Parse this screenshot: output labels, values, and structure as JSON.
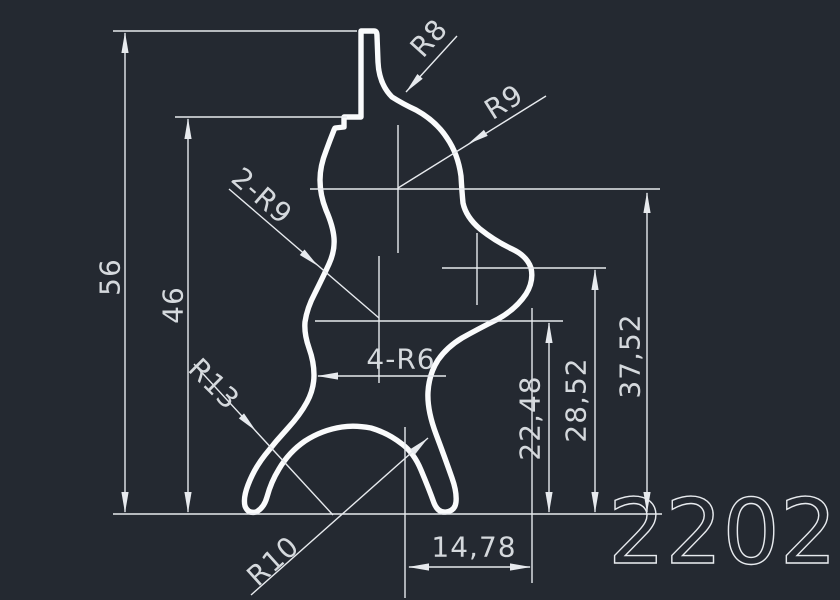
{
  "part_number": "2202",
  "linear_dimensions": {
    "overall_height": "56",
    "step_height": "46",
    "center_height_upper": "37,52",
    "center_height_middle": "28,52",
    "center_height_lower": "22,48",
    "bottom_width": "14,78"
  },
  "radius_dimensions": {
    "top_fillet": "R8",
    "upper_lobe": "R9",
    "left_lobes": "2-R9",
    "waist_fillets": "4-R6",
    "left_leg_fillet": "R13",
    "bottom_arch": "R10"
  },
  "colors": {
    "background": "#242931",
    "profile_line": "#fafbfc",
    "dimension_line": "#e7eaee",
    "dimension_text": "#d5d9dd"
  }
}
